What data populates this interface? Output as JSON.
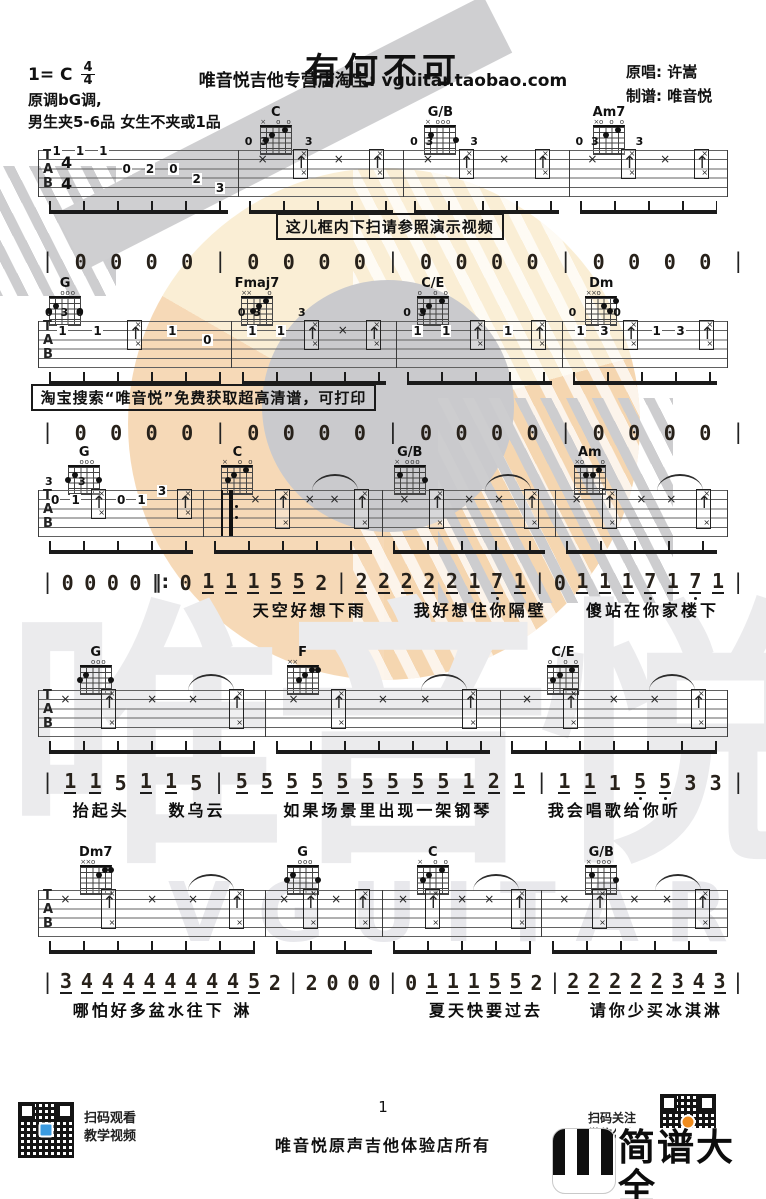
{
  "title": "有何不可",
  "header": {
    "key_prefix": "1= C",
    "time_top": "4",
    "time_bottom": "4",
    "shop_line": "唯音悦吉他专营店淘宝: vguitar.taobao.com",
    "original_singer": "原唱: 许嵩",
    "arranger": "制谱: 唯音悦",
    "key_note": "原调bG调,",
    "capo_note": "男生夹5-6品 女生不夹或1品"
  },
  "tab_letters": [
    "T",
    "A",
    "B"
  ],
  "chord_shapes": {
    "C": "x32010",
    "G/B": "x20003",
    "Am7": "x02010",
    "G": "320003",
    "Fmaj7": "xx3210",
    "C/E": "032010",
    "Dm": "xx0231",
    "Am": "x02210",
    "F": "xx3211",
    "Dm7": "xx0211"
  },
  "systems": [
    {
      "top": 106,
      "chords": [
        {
          "name": "C",
          "x": 36
        },
        {
          "name": "G/B",
          "x": 57.5
        },
        {
          "name": "Am7",
          "x": 79.5
        }
      ],
      "time_sig": [
        "4",
        "4"
      ],
      "measures": [
        {
          "w": 29,
          "ev": [
            "1@1",
            "1@1",
            "1@1",
            "0@3",
            "2@3",
            "0@3",
            "2@4",
            "3@5"
          ]
        },
        {
          "w": 24,
          "ev": [
            "x",
            "b",
            "x",
            "b"
          ],
          "above": "0 3      3"
        },
        {
          "w": 24,
          "ev": [
            "x",
            "b",
            "x",
            "b"
          ],
          "above": "0 3      3"
        },
        {
          "w": 23,
          "ev": [
            "x",
            "b",
            "x",
            "b"
          ],
          "above": "0 3      3"
        }
      ],
      "callout": {
        "text": "这儿框内下扫请参照演示视频",
        "x": 36
      },
      "numbers": [
        "|",
        "0",
        "0",
        "0",
        "0",
        "|",
        "0",
        "0",
        "0",
        "0",
        "|",
        "0",
        "0",
        "0",
        "0",
        "|",
        "0",
        "0",
        "0",
        "0",
        "|"
      ],
      "num_gap": 6
    },
    {
      "top": 277,
      "chords": [
        {
          "name": "G",
          "x": 8.5
        },
        {
          "name": "Fmaj7",
          "x": 33.5
        },
        {
          "name": "C/E",
          "x": 56.5
        },
        {
          "name": "Dm",
          "x": 78.5
        }
      ],
      "measures": [
        {
          "w": 28,
          "ev": [
            "1@2",
            "1@2",
            "b",
            "1@2",
            "0@3"
          ],
          "above": "0 3 0"
        },
        {
          "w": 24,
          "ev": [
            "1@2",
            "1@2",
            "b",
            "x",
            "b"
          ],
          "above": "0 3      3"
        },
        {
          "w": 24,
          "ev": [
            "1@2",
            "1@2",
            "b",
            "1@2",
            "b"
          ],
          "above": "0 3"
        },
        {
          "w": 24,
          "ev": [
            "1@2",
            "3@2",
            "b",
            "1@2",
            "3@2",
            "b"
          ],
          "above": "0      0"
        }
      ],
      "callout": {
        "text": "淘宝搜索“唯音悦”免费获取超高清谱，可打印",
        "x": 4
      },
      "numbers": [
        "|",
        "0",
        "0",
        "0",
        "0",
        "|",
        "0",
        "0",
        "0",
        "0",
        "|",
        "0",
        "0",
        "0",
        "0",
        "|",
        "0",
        "0",
        "0",
        "0",
        "|"
      ],
      "num_gap": 6
    },
    {
      "top": 446,
      "chords": [
        {
          "name": "G",
          "x": 11
        },
        {
          "name": "C",
          "x": 31
        },
        {
          "name": "G/B",
          "x": 53.5
        },
        {
          "name": "Am",
          "x": 77
        }
      ],
      "measures": [
        {
          "w": 24,
          "ev": [
            "0@2",
            "1@2",
            "b",
            "0@2",
            "1@2",
            "3@1",
            "b"
          ],
          "above": "3    3"
        },
        {
          "w": 26,
          "ev": [
            "r",
            "x",
            "B",
            "x",
            "x",
            "B"
          ],
          "tie": 1
        },
        {
          "w": 25,
          "ev": [
            "x",
            "B",
            "x",
            "x",
            "B"
          ],
          "tie": 1
        },
        {
          "w": 25,
          "ev": [
            "x",
            "B",
            "x",
            "x",
            "B"
          ],
          "tie": 1
        }
      ],
      "numbers": [
        "|",
        "0",
        "0",
        "0",
        "0",
        "‖:",
        "0",
        "1_",
        "1_",
        "1_",
        "5_",
        "5_",
        "2",
        "|",
        "2_",
        "2_",
        "2_",
        "2_",
        "2_",
        "1_",
        "7_.",
        "1_",
        "|",
        "0",
        "1_",
        "1_",
        "1_",
        "7_.",
        "1_",
        "7_.",
        "1_",
        "|"
      ],
      "num_gap": 30,
      "lyrics": [
        {
          "t": "天空好想下雨",
          "x": 33
        },
        {
          "t": "我好想住你隔壁",
          "x": 54
        },
        {
          "t": "傻站在你家楼下",
          "x": 76.5
        }
      ]
    },
    {
      "top": 646,
      "chords": [
        {
          "name": "G",
          "x": 12.5
        },
        {
          "name": "F",
          "x": 39.5
        },
        {
          "name": "C/E",
          "x": 73.5
        }
      ],
      "measures": [
        {
          "w": 33,
          "ev": [
            "x",
            "B",
            "x",
            "x",
            "B"
          ],
          "tie": 1
        },
        {
          "w": 34,
          "ev": [
            "x",
            "B",
            "x",
            "x",
            "B"
          ],
          "tie": 1
        },
        {
          "w": 33,
          "ev": [
            "x",
            "B",
            "x",
            "x",
            "B"
          ],
          "tie": 1
        }
      ],
      "numbers": [
        "|",
        "1_",
        "1_",
        "5",
        "1_",
        "1_",
        "5",
        "|",
        "5_",
        "5_",
        "5_",
        "5_",
        "5_",
        "5_",
        "5_",
        "5_",
        "5_",
        "1_",
        "2_",
        "1_",
        "|",
        "1_",
        "1_",
        "1",
        "5_.",
        "5_.",
        "3",
        "3",
        "|"
      ],
      "num_gap": 30,
      "lyrics": [
        {
          "t": "抬起头",
          "x": 9.5
        },
        {
          "t": "数乌云",
          "x": 22
        },
        {
          "t": "如果场景里出现一架钢琴",
          "x": 37
        },
        {
          "t": "我会唱歌给你听",
          "x": 71.5
        }
      ]
    },
    {
      "top": 846,
      "chords": [
        {
          "name": "Dm7",
          "x": 12.5
        },
        {
          "name": "G",
          "x": 39.5
        },
        {
          "name": "C",
          "x": 56.5
        },
        {
          "name": "G/B",
          "x": 78.5
        }
      ],
      "measures": [
        {
          "w": 33,
          "ev": [
            "x",
            "B",
            "x",
            "x",
            "B"
          ],
          "tie": 1
        },
        {
          "w": 17,
          "ev": [
            "x",
            "B",
            "x",
            "B"
          ]
        },
        {
          "w": 23,
          "ev": [
            "x",
            "B",
            "x",
            "x",
            "B"
          ],
          "tie": 1
        },
        {
          "w": 27,
          "ev": [
            "x",
            "B",
            "x",
            "x",
            "B"
          ],
          "tie": 1
        }
      ],
      "numbers": [
        "|",
        "3_",
        "4_",
        "4_",
        "4_",
        "4_",
        "4_",
        "4_",
        "4_",
        "4_",
        "5_",
        "2",
        "|",
        "2",
        "0",
        "0",
        "0",
        "|",
        "0",
        "1_",
        "1_",
        "1_",
        "5_",
        "5_",
        "2",
        "|",
        "2_",
        "2_",
        "2_",
        "2_",
        "2_",
        "3_",
        "4_",
        "3_",
        "|"
      ],
      "num_gap": 30,
      "lyrics": [
        {
          "t": "哪怕好多盆水往下 淋",
          "x": 9.5
        },
        {
          "t": "夏天快要过去",
          "x": 56
        },
        {
          "t": "请你少买冰淇淋",
          "x": 77
        }
      ]
    }
  ],
  "footer": {
    "qr_caption_1": "扫码观看",
    "qr_caption_2": "教学视频",
    "page_number": "1",
    "copyright": "唯音悦原声吉他体验店所有",
    "follow_caption_1": "扫码关注",
    "follow_caption_2": "微信公众号",
    "brand_name": "简谱大全",
    "brand_domain": "jianpudq.com"
  },
  "watermark": {
    "hanzi": "唯音悦",
    "latin": "VGUITAR",
    "gray": "#c8c8cb",
    "cream": "#faeed3",
    "peach": "#f5d4ac"
  }
}
